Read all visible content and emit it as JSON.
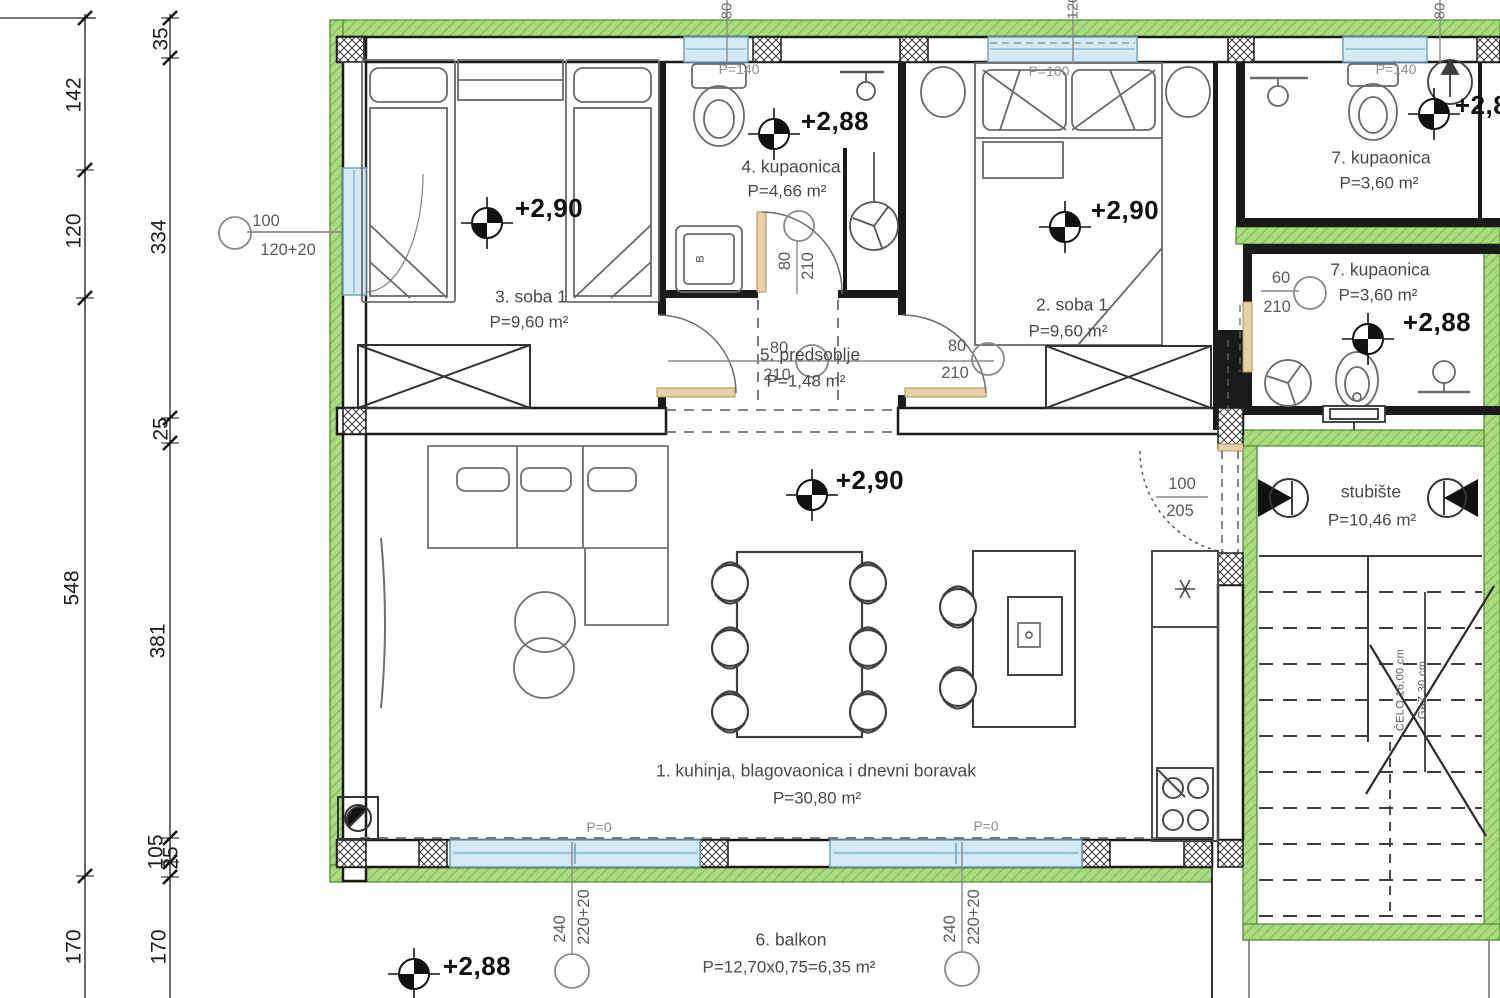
{
  "rooms": [
    {
      "name": "3. soba 1",
      "area": "P=9,60 m²"
    },
    {
      "name": "4. kupaonica",
      "area": "P=4,66 m²"
    },
    {
      "name": "2. soba 1",
      "area": "P=9,60 m²"
    },
    {
      "name": "7. kupaonica",
      "area": "P=3,60 m²"
    },
    {
      "name": "7. kupaonica",
      "area": "P=3,60 m²"
    },
    {
      "name": "5. predsoblje",
      "area": "P=1,48 m²"
    },
    {
      "name": "1. kuhinja, blagovaonica i dnevni boravak",
      "area": "P=30,80 m²"
    },
    {
      "name": "stubište",
      "area": "P=10,46 m²"
    },
    {
      "name": "6. balkon",
      "area": "P=12,70x0,75=6,35 m²"
    }
  ],
  "elevations": {
    "soba3": "+2,90",
    "kupaonica4": "+2,88",
    "soba2": "+2,90",
    "living": "+2,90",
    "kupaonica7": "+2,88",
    "kupaonica7_top": "+2,88",
    "balkon": "+2,88"
  },
  "dimensions": {
    "outer": [
      "142",
      "120",
      "548",
      "170"
    ],
    "inner": [
      "35",
      "334",
      "25",
      "381",
      "105",
      "25",
      "170"
    ]
  },
  "openings": {
    "window_left": {
      "w": "100",
      "h": "120+20"
    },
    "door_bath4": {
      "w": "80",
      "h": "210"
    },
    "door_hall_left": {
      "w": "80",
      "h": "210"
    },
    "door_hall_right": {
      "w": "80",
      "h": "210"
    },
    "door_bath7": {
      "w": "60",
      "h": "210"
    },
    "door_entry": {
      "w": "100",
      "h": "205"
    },
    "door_balcony_1": {
      "w": "240",
      "h": "220+20"
    },
    "door_balcony_2": {
      "w": "240",
      "h": "220+20"
    },
    "window_bath4": {
      "w": "80",
      "parapet": "P=140"
    },
    "window_soba2": {
      "w": "120",
      "parapet": "P=100"
    },
    "window_bath7": {
      "w": "80",
      "parapet": "P=140"
    }
  },
  "annotations": {
    "parapet_zero_left": "P=0",
    "parapet_zero_right": "P=0",
    "stair_riser": "ČELO 16,00 cm",
    "stair_tread": "GAZ 30 cm",
    "washer_label": "B"
  },
  "colors": {
    "wall_green": "#abdb80",
    "window_blue": "#d3e9f4",
    "door_tan": "#e7d2a8",
    "line_black": "#1a1a1a"
  }
}
